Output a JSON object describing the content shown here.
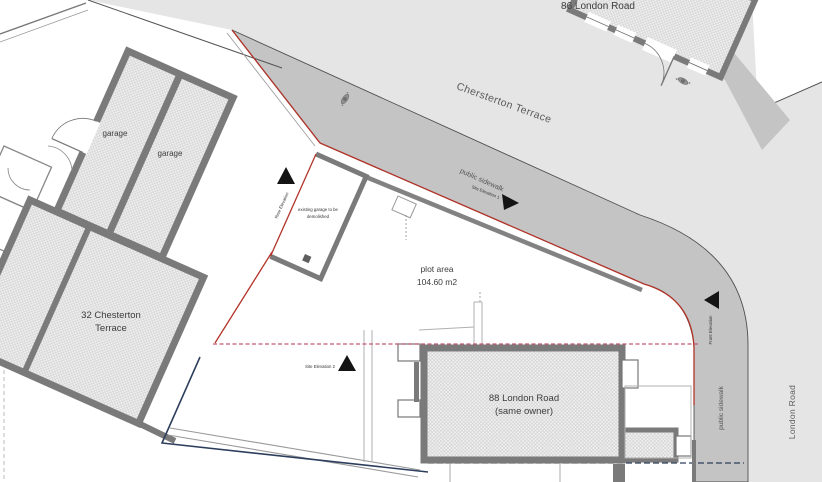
{
  "streets": {
    "chesterton_label": "Chersterton Terrace",
    "london_label": "London Road"
  },
  "sidewalks": {
    "chesterton_label": "public sidewalk",
    "london_label": "public sidewalk"
  },
  "buildings": {
    "no86": {
      "name": "86 London Road"
    },
    "no88": {
      "name": "88 London Road",
      "note": "(same owner)"
    },
    "no32": {
      "name_line1": "32 Chesterton",
      "name_line2": "Terrace"
    },
    "garage_west": {
      "label": "garage"
    },
    "garage_east": {
      "label": "garage"
    },
    "garage_demolish": {
      "label_line1": "existing garage to be",
      "label_line2": "demolished"
    }
  },
  "plot": {
    "label": "plot area",
    "area": "104.60 m2"
  },
  "elevation_markers": {
    "site_elevation_1": "Site Elevation 1",
    "site_elevation_2": "Site Elevation 2",
    "rear_elevation": "Rear Elevation",
    "front_elevation": "Front Elevation"
  },
  "colors": {
    "street": "#e5e5e5",
    "sidewalk": "#c4c4c4",
    "wall": "#7a7a7a",
    "boundary": "#b23429",
    "dashed": "#c25a70",
    "utility": "#2c3e5c",
    "hatch": "#cfcfcf"
  }
}
